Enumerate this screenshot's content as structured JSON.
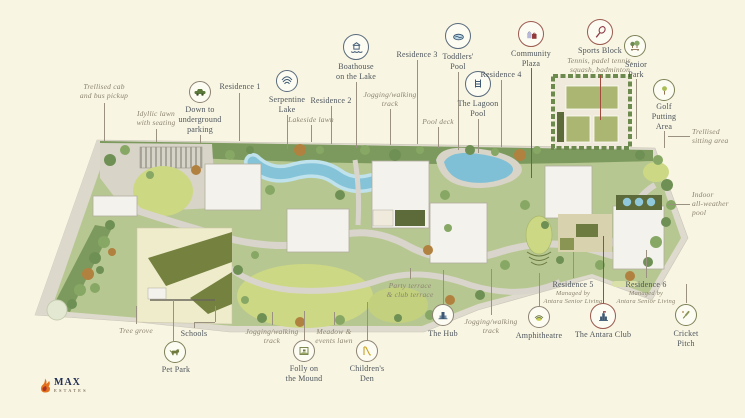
{
  "title": "Antara residential masterplan site map",
  "brand": {
    "name": "MAX",
    "sub": "ESTATES"
  },
  "colors": {
    "background": "#f8f5e2",
    "leader_line": "#9a9180",
    "accent_red": "#a34a3f",
    "label_text": "#4c545b",
    "italic_label_text": "#8b8470",
    "water": "#85c3d8",
    "lawn": "#ccd883",
    "trees": "#7d9a5e",
    "building": "#f3f2ec",
    "road": "#d9d5cc"
  },
  "labels": {
    "trellised_cab": "Trellised cab\nand bus pickup",
    "idyllic_lawn": "Idyllic lawn\nwith seating",
    "underground_parking": "Down to\nunderground\nparking",
    "residence_1": "Residence 1",
    "serpentine_lake": "Serpentine\nLake",
    "residence_2": "Residence 2",
    "lakeside_lawn": "Lakeside lawn",
    "boathouse": "Boathouse\non the Lake",
    "residence_3": "Residence 3",
    "jogging_track_top": "Jogging/walking\ntrack",
    "toddlers_pool": "Toddlers'\nPool",
    "pool_deck": "Pool deck",
    "lagoon_pool": "The Lagoon\nPool",
    "residence_4": "Residence 4",
    "community_plaza": "Community\nPlaza",
    "sports_block": "Sports Block",
    "sports_block_sub": "Tennis, padel tennis,\nsquash, badminton",
    "senior_park": "Senior\nPark",
    "golf_putting": "Golf\nPutting\nArea",
    "trellised_sitting": "Trellised\nsitting area",
    "indoor_pool": "Indoor\nall-weather\npool",
    "tree_grove": "Tree grove",
    "schools": "Schools",
    "pet_park": "Pet Park",
    "jogging_track_bl": "Jogging/walking\ntrack",
    "folly": "Folly on\nthe Mound",
    "meadow": "Meadow &\nevents lawn",
    "childrens_den": "Children's\nDen",
    "party_terrace": "Party terrace\n& club terrace",
    "the_hub": "The Hub",
    "jogging_track_br": "Jogging/walking\ntrack",
    "amphitheatre": "Amphitheatre",
    "residence_5": "Residence 5",
    "residence_5_sub": "Managed by\nAntara Senior Living",
    "antara_club": "The Antara Club",
    "residence_6": "Residence 6",
    "residence_6_sub": "Managed by\nAntara Senior Living",
    "cricket_pitch": "Cricket\nPitch"
  },
  "icons": {
    "underground_parking": "car-icon",
    "serpentine_lake": "lake-icon",
    "boathouse": "boathouse-icon",
    "toddlers_pool": "toddler-pool-icon",
    "lagoon_pool": "pool-ladder-icon",
    "community_plaza": "shopping-bags-icon",
    "sports_block": "tennis-racket-icon",
    "senior_park": "park-bench-icon",
    "golf_putting": "golf-icon",
    "pet_park": "dog-icon",
    "folly": "folly-icon",
    "childrens_den": "slide-icon",
    "the_hub": "building-icon",
    "amphitheatre": "amphitheatre-icon",
    "antara_club": "club-building-icon",
    "cricket_pitch": "cricket-bat-icon",
    "logo": "flame-icon"
  }
}
